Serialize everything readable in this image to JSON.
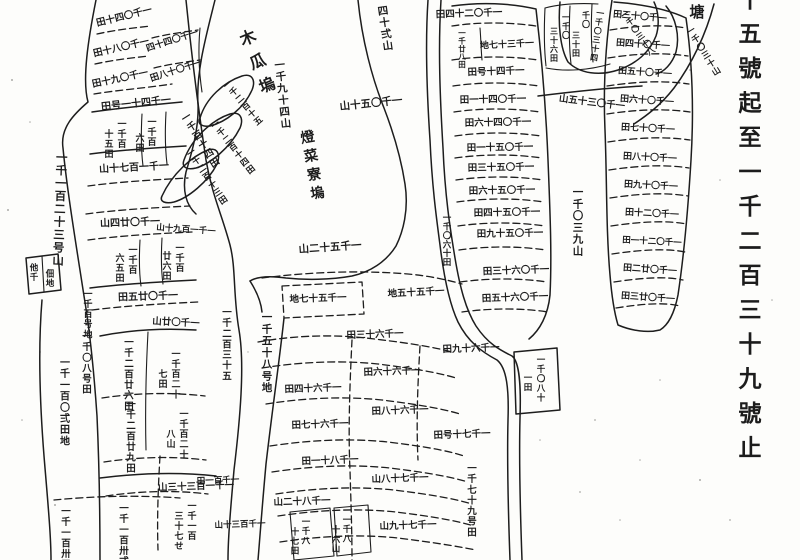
{
  "colors": {
    "paper": "#fdfdfb",
    "ink": "#1d1d1d"
  },
  "margin": {
    "caption": "十五號起至一千二百三十九號止",
    "corner_char": "塘"
  },
  "map": {
    "labels": [
      {
        "t": "十五號起至一千二百三十九號止",
        "d": "v",
        "x": 750,
        "y": -16,
        "s": 23,
        "p": 1.5,
        "n": "margin-caption"
      },
      {
        "t": "塘",
        "d": "v",
        "x": 697,
        "y": 2,
        "s": 15,
        "n": "corner-char"
      },
      {
        "t": "木瓜塢",
        "d": "v",
        "x": 244,
        "y": 28,
        "s": 16,
        "r": -22,
        "p": 1.6,
        "n": "place-name-label"
      },
      {
        "t": "燈菜寮塢",
        "d": "v",
        "x": 306,
        "y": 128,
        "s": 14,
        "r": -10,
        "p": 1.35,
        "n": "place-name-label"
      },
      {
        "t": "一千九十四山",
        "d": "v",
        "x": 279,
        "y": 58,
        "s": 10.5,
        "r": -6
      },
      {
        "t": "一千一百二十三号山",
        "d": "v",
        "x": 62,
        "y": 150,
        "s": 11.5,
        "r": 2
      },
      {
        "t": "一千〇三九山",
        "d": "v",
        "x": 578,
        "y": 185,
        "s": 10.5
      },
      {
        "t": "一千〇四十田",
        "d": "r",
        "x": 124,
        "y": 16,
        "r": -14,
        "s": 9.5
      },
      {
        "t": "一千〇八十田",
        "d": "r",
        "x": 121,
        "y": 47,
        "r": -13,
        "s": 9.5
      },
      {
        "t": "一千〇九十田",
        "d": "r",
        "x": 120,
        "y": 78,
        "r": -12,
        "s": 9.5
      },
      {
        "t": "一千〇四十四",
        "d": "r",
        "x": 172,
        "y": 40,
        "r": -18,
        "s": 9
      },
      {
        "t": "一千〇十八田",
        "d": "r",
        "x": 176,
        "y": 70,
        "r": -18,
        "s": 9
      },
      {
        "t": "一千四十一号田",
        "d": "r",
        "x": 136,
        "y": 103,
        "r": -6,
        "s": 10
      },
      {
        "t": "一千百",
        "d": "v",
        "x": 122,
        "y": 118,
        "s": 9
      },
      {
        "t": "十五田",
        "d": "v",
        "x": 109,
        "y": 128,
        "s": 9
      },
      {
        "t": "一千百",
        "d": "v",
        "x": 152,
        "y": 116,
        "s": 9
      },
      {
        "t": "六田",
        "d": "v",
        "x": 140,
        "y": 132,
        "s": 9
      },
      {
        "t": "一千百十四田",
        "d": "v",
        "x": 183,
        "y": 112,
        "r": -32,
        "s": 9.5
      },
      {
        "t": "一千一百七十山",
        "d": "r",
        "x": 134,
        "y": 167,
        "r": -3,
        "s": 10
      },
      {
        "t": "一千〇廿四山",
        "d": "r",
        "x": 130,
        "y": 222,
        "r": -2,
        "s": 10
      },
      {
        "t": "一千一百九十山",
        "d": "r",
        "x": 186,
        "y": 229,
        "r": 4,
        "s": 8.5
      },
      {
        "t": "一千百",
        "d": "v",
        "x": 133,
        "y": 244,
        "s": 9
      },
      {
        "t": "六五田",
        "d": "v",
        "x": 120,
        "y": 252,
        "s": 9
      },
      {
        "t": "一千百",
        "d": "v",
        "x": 180,
        "y": 242,
        "s": 9
      },
      {
        "t": "廿六田",
        "d": "v",
        "x": 167,
        "y": 250,
        "s": 9
      },
      {
        "t": "一千〇廿五田",
        "d": "r",
        "x": 148,
        "y": 296,
        "r": -2,
        "s": 10
      },
      {
        "t": "一千〇廿山",
        "d": "r",
        "x": 176,
        "y": 322,
        "r": 3,
        "s": 9.5
      },
      {
        "t": "他千",
        "d": "v",
        "x": 34,
        "y": 262,
        "s": 8.5
      },
      {
        "t": "佃地",
        "d": "v",
        "x": 50,
        "y": 268,
        "s": 8.5
      },
      {
        "t": "一千百号地",
        "d": "v",
        "x": 88,
        "y": 288,
        "s": 9
      },
      {
        "t": "一千二百三十五",
        "d": "v",
        "x": 227,
        "y": 306,
        "s": 9.5
      },
      {
        "t": "一千五十八号地",
        "d": "v",
        "x": 267,
        "y": 310,
        "s": 10.5
      },
      {
        "t": "一千〇八号田",
        "d": "v",
        "x": 87,
        "y": 330,
        "s": 9.5
      },
      {
        "t": "一千一百〇弍田地",
        "d": "v",
        "x": 65,
        "y": 356,
        "s": 10
      },
      {
        "t": "一千二百廿六田",
        "d": "v",
        "x": 129,
        "y": 336,
        "s": 9.5
      },
      {
        "t": "一千百二十",
        "d": "v",
        "x": 176,
        "y": 348,
        "s": 9
      },
      {
        "t": "七田",
        "d": "v",
        "x": 163,
        "y": 368,
        "s": 9
      },
      {
        "t": "一千百二十",
        "d": "v",
        "x": 184,
        "y": 408,
        "s": 9
      },
      {
        "t": "八山",
        "d": "v",
        "x": 171,
        "y": 428,
        "s": 9
      },
      {
        "t": "一千二百廿九田",
        "d": "v",
        "x": 131,
        "y": 398,
        "s": 9.5
      },
      {
        "t": "一千一百三十三山",
        "d": "r",
        "x": 196,
        "y": 486,
        "r": -2,
        "s": 9.5
      },
      {
        "t": "一千一百",
        "d": "v",
        "x": 192,
        "y": 500,
        "s": 9
      },
      {
        "t": "三十七せ",
        "d": "v",
        "x": 179,
        "y": 510,
        "s": 9
      },
      {
        "t": "一千一百卅五",
        "d": "v",
        "x": 66,
        "y": 505,
        "s": 9.5
      },
      {
        "t": "一千一百卅弍",
        "d": "v",
        "x": 124,
        "y": 502,
        "s": 9.5
      },
      {
        "t": "一千二百十五",
        "d": "v",
        "x": 224,
        "y": 80,
        "s": 8.5,
        "r": -40
      },
      {
        "t": "一千二百十四田",
        "d": "v",
        "x": 212,
        "y": 120,
        "s": 8.5,
        "r": -38
      },
      {
        "t": "一千二百十三田",
        "d": "v",
        "x": 188,
        "y": 148,
        "s": 8.5,
        "r": -34
      },
      {
        "t": "四十弍山",
        "d": "v",
        "x": 382,
        "y": 4,
        "s": 10.5,
        "r": -8
      },
      {
        "t": "一千〇五十山",
        "d": "r",
        "x": 371,
        "y": 103,
        "r": -6,
        "s": 10.5
      },
      {
        "t": "一千五十二山",
        "d": "r",
        "x": 330,
        "y": 247,
        "r": -4,
        "s": 10.5
      },
      {
        "t": "一千五十七地",
        "d": "r",
        "x": 318,
        "y": 298,
        "r": -2,
        "s": 9.5
      },
      {
        "t": "一千五十五地",
        "d": "r",
        "x": 416,
        "y": 292,
        "r": -3,
        "s": 9.5
      },
      {
        "t": "一千六十三田",
        "d": "r",
        "x": 375,
        "y": 334,
        "r": -2,
        "s": 9.5
      },
      {
        "t": "一千〇二十四田",
        "d": "r",
        "x": 469,
        "y": 13,
        "r": -2,
        "s": 9.5
      },
      {
        "t": "一千廿八田",
        "d": "v",
        "x": 462,
        "y": 28,
        "s": 7.5,
        "p": 1.05
      },
      {
        "t": "一千三十七地",
        "d": "r",
        "x": 507,
        "y": 44,
        "r": -3,
        "s": 9
      },
      {
        "t": "一千四十号田",
        "d": "r",
        "x": 496,
        "y": 71,
        "r": -2,
        "s": 9.5
      },
      {
        "t": "一千〇四十一田",
        "d": "r",
        "x": 493,
        "y": 99,
        "r": -1,
        "s": 9.5
      },
      {
        "t": "一千〇四十六田",
        "d": "r",
        "x": 498,
        "y": 122,
        "r": -1,
        "s": 9.5
      },
      {
        "t": "一千〇五十一田",
        "d": "r",
        "x": 500,
        "y": 147,
        "r": -1,
        "s": 9.5
      },
      {
        "t": "一千〇五十三田",
        "d": "r",
        "x": 501,
        "y": 167,
        "r": -1,
        "s": 9.5
      },
      {
        "t": "一千〇五十六田",
        "d": "r",
        "x": 502,
        "y": 190,
        "r": -1,
        "s": 9.5
      },
      {
        "t": "一千〇五十四田",
        "d": "r",
        "x": 507,
        "y": 212,
        "r": -1,
        "s": 9.5
      },
      {
        "t": "一千〇五十九田",
        "d": "r",
        "x": 510,
        "y": 233,
        "r": -1,
        "s": 9.5
      },
      {
        "t": "一千〇六十田",
        "d": "v",
        "x": 447,
        "y": 212,
        "s": 8.5,
        "p": 1.05
      },
      {
        "t": "一千〇六十三田",
        "d": "r",
        "x": 516,
        "y": 270,
        "r": -2,
        "s": 9.5
      },
      {
        "t": "一千〇六十五田",
        "d": "r",
        "x": 515,
        "y": 297,
        "r": -2,
        "s": 9.5
      },
      {
        "t": "一千六十九田",
        "d": "r",
        "x": 471,
        "y": 348,
        "r": -2,
        "s": 9.5
      },
      {
        "t": "一千〇",
        "d": "v",
        "x": 566,
        "y": 12,
        "s": 8
      },
      {
        "t": "三十六田",
        "d": "v",
        "x": 554,
        "y": 26,
        "s": 8
      },
      {
        "t": "千〇",
        "d": "v",
        "x": 586,
        "y": 10,
        "s": 8
      },
      {
        "t": "三十田",
        "d": "v",
        "x": 576,
        "y": 30,
        "s": 8
      },
      {
        "t": "一千〇三十四",
        "d": "v",
        "x": 601,
        "y": 8,
        "s": 8,
        "r": 8
      },
      {
        "t": "一千〇三十八",
        "d": "v",
        "x": 622,
        "y": 10,
        "s": 8,
        "r": -35
      },
      {
        "t": "一千〇三十山",
        "d": "v",
        "x": 688,
        "y": 26,
        "s": 8.5,
        "r": -32
      },
      {
        "t": "一千〇三十五山",
        "d": "r",
        "x": 592,
        "y": 102,
        "r": 7,
        "s": 9.5
      },
      {
        "t": "一千〇十三田",
        "d": "r",
        "x": 640,
        "y": 16,
        "r": 5,
        "s": 9
      },
      {
        "t": "一千〇十四田",
        "d": "r",
        "x": 643,
        "y": 44,
        "r": 4,
        "s": 9
      },
      {
        "t": "一千〇十五田",
        "d": "r",
        "x": 645,
        "y": 72,
        "r": 4,
        "s": 9
      },
      {
        "t": "一千〇十六田",
        "d": "r",
        "x": 647,
        "y": 100,
        "r": 4,
        "s": 9
      },
      {
        "t": "一千〇十七田",
        "d": "r",
        "x": 648,
        "y": 128,
        "r": 3,
        "s": 9
      },
      {
        "t": "一千〇十八田",
        "d": "r",
        "x": 650,
        "y": 157,
        "r": 3,
        "s": 9
      },
      {
        "t": "一千〇十九田",
        "d": "r",
        "x": 651,
        "y": 185,
        "r": 3,
        "s": 9
      },
      {
        "t": "一千〇二十田",
        "d": "r",
        "x": 652,
        "y": 213,
        "r": 3,
        "s": 9
      },
      {
        "t": "一千〇二十一田",
        "d": "r",
        "x": 652,
        "y": 241,
        "r": 3,
        "s": 8.5
      },
      {
        "t": "一千〇廿二田",
        "d": "r",
        "x": 650,
        "y": 269,
        "r": 4,
        "s": 9
      },
      {
        "t": "一千〇廿三田",
        "d": "r",
        "x": 648,
        "y": 297,
        "r": 4,
        "s": 9
      },
      {
        "t": "一千六十六田",
        "d": "r",
        "x": 392,
        "y": 371,
        "r": -2,
        "s": 9.5
      },
      {
        "t": "一千六十四田",
        "d": "r",
        "x": 313,
        "y": 388,
        "r": -2,
        "s": 9.5
      },
      {
        "t": "一千六十七田",
        "d": "r",
        "x": 320,
        "y": 424,
        "r": -2,
        "s": 9.5
      },
      {
        "t": "一千六十八田",
        "d": "r",
        "x": 400,
        "y": 410,
        "r": -2,
        "s": 9.5
      },
      {
        "t": "一千八十一田",
        "d": "r",
        "x": 330,
        "y": 460,
        "r": -2,
        "s": 9.5
      },
      {
        "t": "一千七十八山",
        "d": "r",
        "x": 400,
        "y": 478,
        "r": -2,
        "s": 9.5
      },
      {
        "t": "一千八十二山",
        "d": "r",
        "x": 302,
        "y": 501,
        "r": -2,
        "s": 9.5
      },
      {
        "t": "一千七十九山",
        "d": "r",
        "x": 408,
        "y": 525,
        "r": -2,
        "s": 9.5
      },
      {
        "t": "一千百一田",
        "d": "r",
        "x": 218,
        "y": 480,
        "r": -2,
        "s": 8.5
      },
      {
        "t": "一千百三十山",
        "d": "r",
        "x": 240,
        "y": 524,
        "r": -2,
        "s": 8.5
      },
      {
        "t": "一千八",
        "d": "v",
        "x": 306,
        "y": 516,
        "s": 8.5
      },
      {
        "t": "十七田",
        "d": "v",
        "x": 295,
        "y": 526,
        "s": 8.5
      },
      {
        "t": "一千八",
        "d": "v",
        "x": 347,
        "y": 514,
        "s": 8.5
      },
      {
        "t": "十六山",
        "d": "v",
        "x": 336,
        "y": 524,
        "s": 8.5
      },
      {
        "t": "一千七十号田",
        "d": "r",
        "x": 462,
        "y": 434,
        "r": -2,
        "s": 9.5
      },
      {
        "t": "一千七十九号田",
        "d": "v",
        "x": 472,
        "y": 462,
        "s": 9.5
      },
      {
        "t": "一千〇八十",
        "d": "v",
        "x": 541,
        "y": 354,
        "s": 8.5
      },
      {
        "t": "一田",
        "d": "v",
        "x": 528,
        "y": 372,
        "s": 8.5
      }
    ]
  }
}
